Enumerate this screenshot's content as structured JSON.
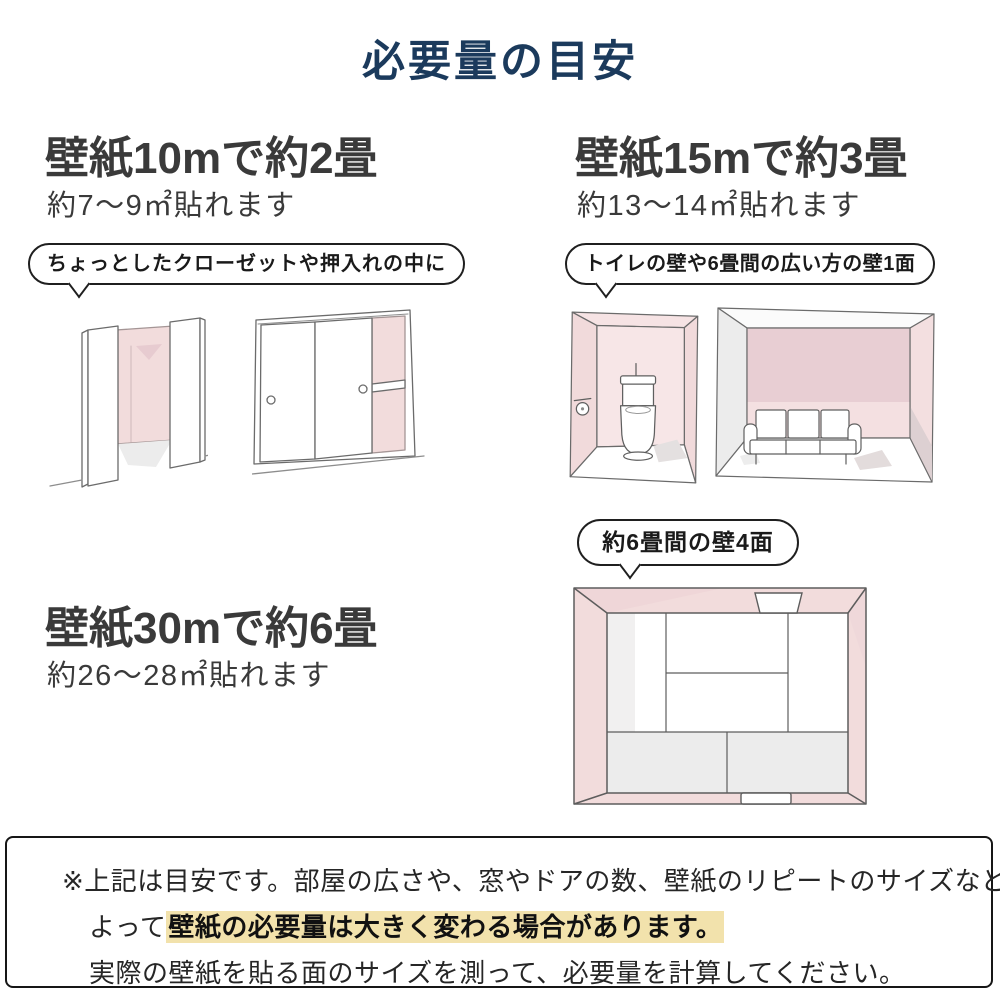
{
  "title": {
    "text": "必要量の目安"
  },
  "sections": {
    "s10": {
      "heading": "壁紙10mで約2畳",
      "subheading": "約7〜9㎡貼れます",
      "bubble": "ちょっとしたクローゼットや押入れの中に",
      "illustrations": [
        "open-closet",
        "sliding-closet"
      ]
    },
    "s15": {
      "heading": "壁紙15mで約3畳",
      "subheading": "約13〜14㎡貼れます",
      "bubble": "トイレの壁や6畳間の広い方の壁1面",
      "illustrations": [
        "toilet-room",
        "sofa-room"
      ]
    },
    "s30": {
      "heading": "壁紙30mで約6畳",
      "subheading": "約26〜28㎡貼れます",
      "bubble": "約6畳間の壁4面",
      "illustrations": [
        "tatami-room-top-view"
      ]
    }
  },
  "note": {
    "line1": "※上記は目安です。部屋の広さや、窓やドアの数、壁紙のリピートのサイズなどに",
    "line2_prefix": "よって",
    "line2_highlight": "壁紙の必要量は大きく変わる場合があります。",
    "line3": "実際の壁紙を貼る面のサイズを測って、必要量を計算してください。"
  },
  "colors": {
    "title_navy": "#1b3a5c",
    "heading_gray": "#3a3a3a",
    "wall_pink": "#f2dcdc",
    "wall_pink_dark": "#e8ced3",
    "wall_gray": "#ececec",
    "highlight_yellow": "#f2e2ac",
    "outline_black": "#1f1f1f",
    "sketch_line": "#6a6a6a"
  }
}
